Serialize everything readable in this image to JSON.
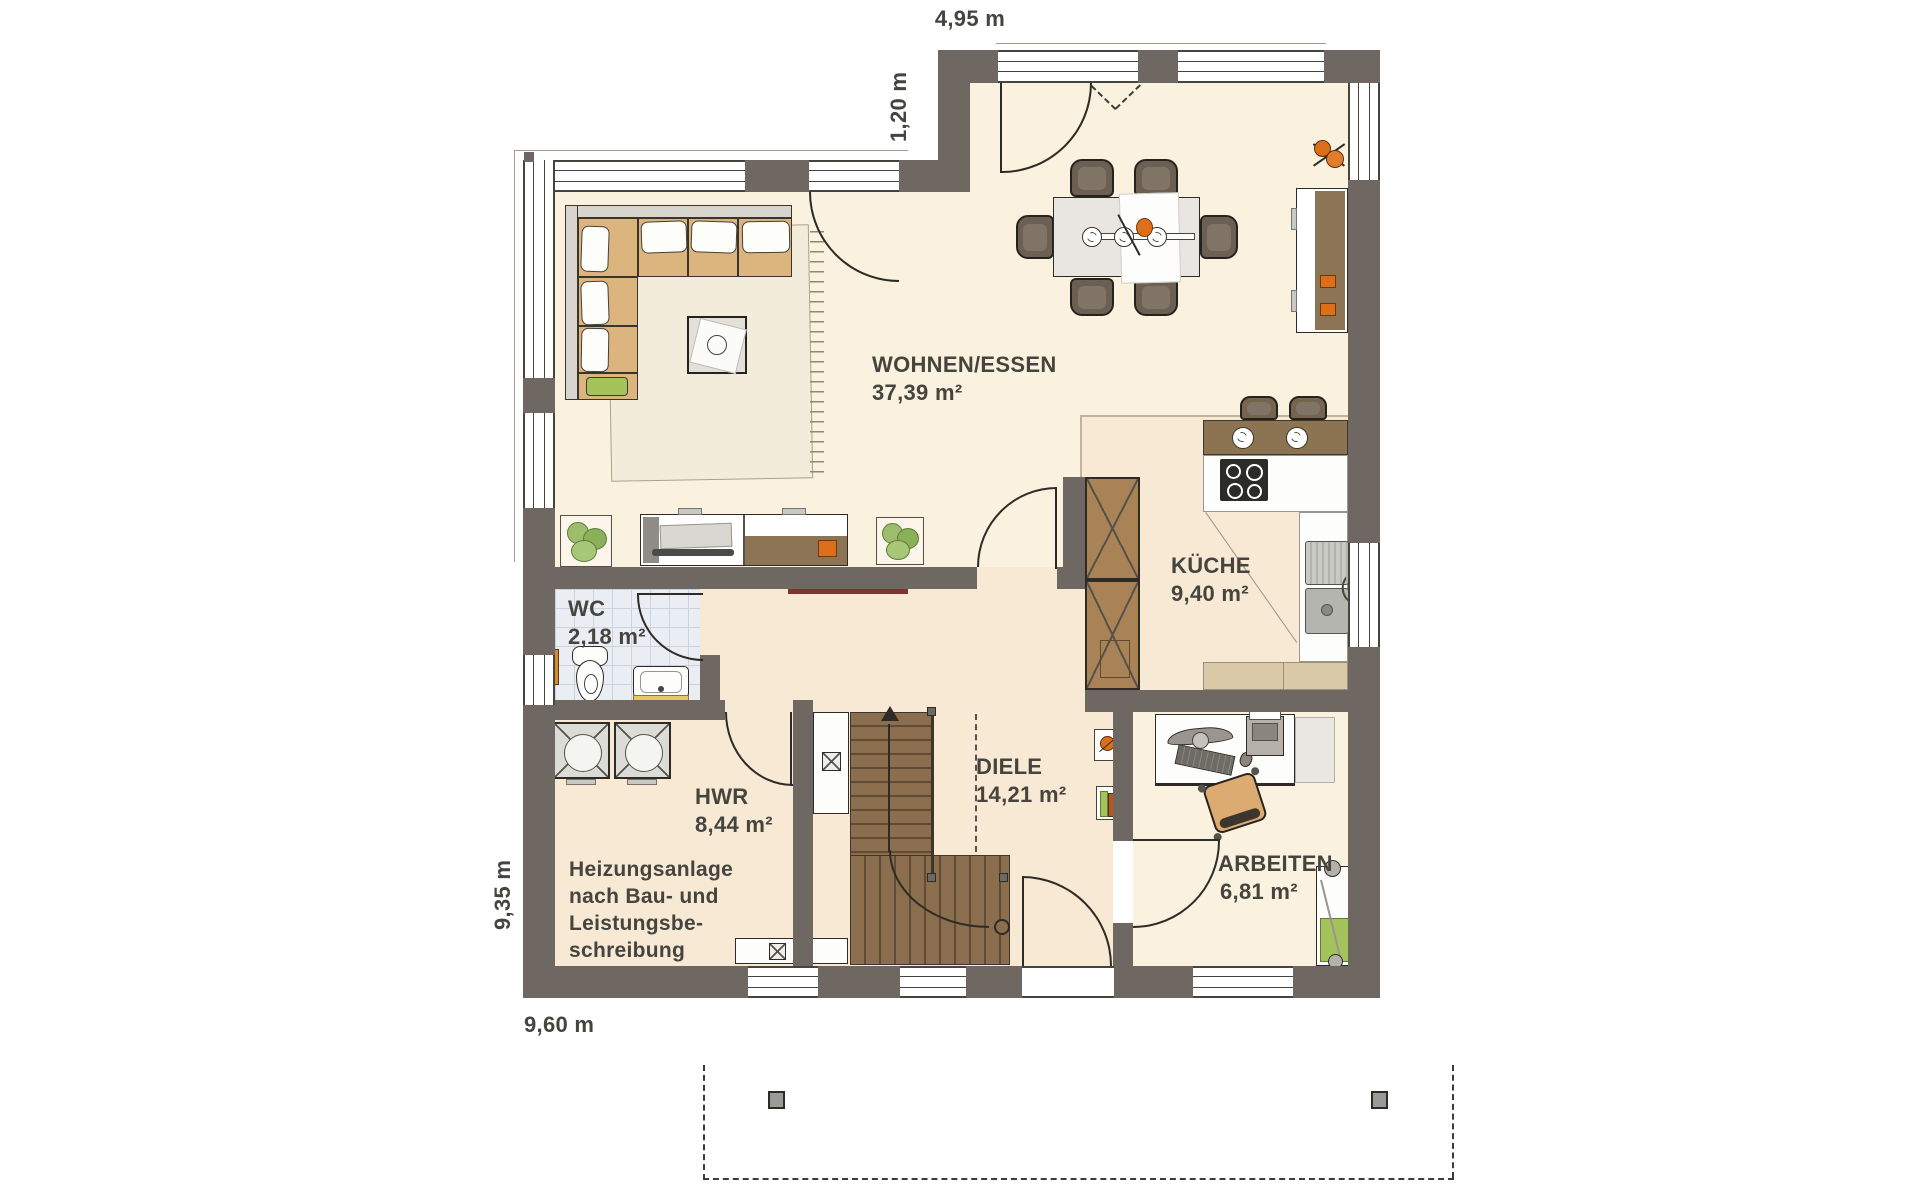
{
  "plan": {
    "title": "Erdgeschoss Grundriss",
    "rooms": [
      {
        "id": "wohnen_essen",
        "name": "WOHNEN/ESSEN",
        "area": "37,39 m²"
      },
      {
        "id": "kueche",
        "name": "KÜCHE",
        "area": "9,40 m²"
      },
      {
        "id": "wc",
        "name": "WC",
        "area": "2,18 m²"
      },
      {
        "id": "hwr",
        "name": "HWR",
        "area": "8,44 m²"
      },
      {
        "id": "diele",
        "name": "DIELE",
        "area": "14,21 m²"
      },
      {
        "id": "arbeiten",
        "name": "ARBEITEN",
        "area": "6,81 m²"
      }
    ],
    "note_lines": [
      "Heizungsanlage",
      "nach Bau- und",
      "Leistungsbe-",
      "schreibung"
    ],
    "dimensions": {
      "top": "4,95 m",
      "step": "1,20 m",
      "left": "9,35 m",
      "bottom": "9,60 m"
    },
    "colors": {
      "wall": "#6F6862",
      "floor_cream": "#FAF2DF",
      "floor_warm": "#F7E9D4",
      "tile": "#EAEEF4",
      "wood": "#8A6E4E",
      "sofa_tan": "#DCB47D",
      "accent_orange": "#DD6F1B",
      "accent_green": "#A5C35B",
      "counter_beige": "#D9C9A6",
      "cabinet_brown": "#A98356",
      "text": "#45443E"
    }
  }
}
